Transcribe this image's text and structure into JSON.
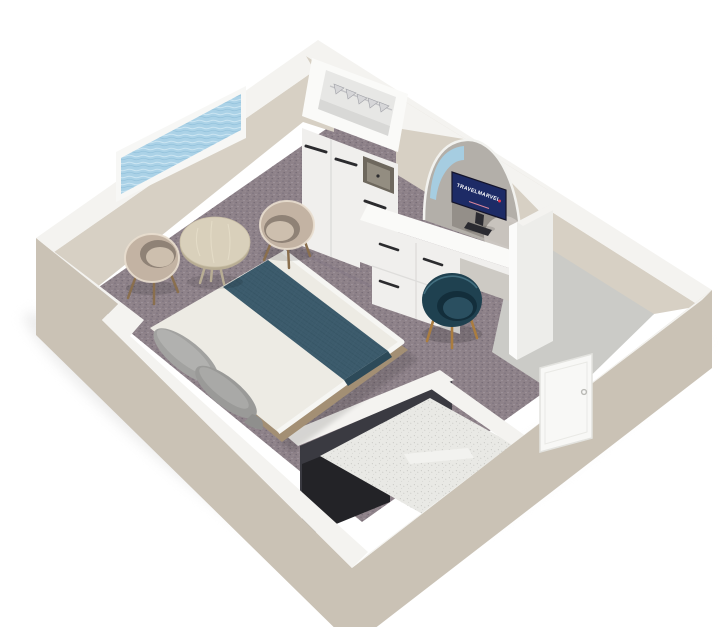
{
  "meta": {
    "scene": "cruise-cabin-3d-cutaway-floorplan",
    "view": "isometric-top-down"
  },
  "tv": {
    "brand": "TRAVELMARVEL",
    "screen": "#1d2b66",
    "frame": "#14142a",
    "stand": "#2a2a30",
    "dot": "#e0374e",
    "tagline_bar": "#ef8fa0"
  },
  "colors": {
    "background": "#ffffff",
    "wall_cut": "#f4f3f0",
    "wall_interior": "#d7d0c4",
    "wall_exterior": "#cac2b5",
    "window_frame": "#f7f7f5",
    "window_water": "#abd2e7",
    "carpet": "#8e8289",
    "entry_floor": "#cbcbc7",
    "cabinet_white": "#f0efed",
    "cabinet_top": "#fafaf8",
    "cabinet_interior": "#e7e7e5",
    "handle_dark": "#2b2b2e",
    "safe_recess": "#6e685e",
    "safe_front": "#938d81",
    "mirror": "#b3afa9",
    "mirror_dark": "#8e8a84",
    "mirror_light": "#cdc9c3",
    "mirror_water": "#a6cde1",
    "bed_duvet": "#edebe4",
    "bed_runner": "#3c5b6c",
    "bed_runner_dark": "#2d4a59",
    "bed_pillow": "#a2a2a0",
    "bed_wood": "#a38f74",
    "bed_rim": "#f6f6f3",
    "chair_shell": "#c3b3a3",
    "chair_inner": "#8f8276",
    "chair_seat": "#cdbfae",
    "chair_rim": "#e9decf",
    "chair_leg": "#8a6f4e",
    "armchair_shell": "#1f4150",
    "armchair_seat": "#2a4f60",
    "armchair_dark": "#132e3b",
    "armchair_leg": "#aa7d40",
    "table_top": "#d9d0bb",
    "table_edge": "#b8ad94",
    "bath_wall_dark": "#3a3a41",
    "bath_vanity": "#232327",
    "bath_floor": "#e9e9e5",
    "bath_speckle_gap": "#dcdcd8",
    "door_white": "#f8f8f6",
    "door_frame": "#e3e3df",
    "door_handle": "#b9b9b5",
    "hanger": "#d6d6d8",
    "hanger_hook": "#6a6b72"
  },
  "objects": [
    "sea-view-window",
    "wardrobe-with-hangers",
    "safe-niche",
    "dresser-desk-with-drawers",
    "arched-mirror",
    "tv",
    "double-bed-with-teal-runner",
    "tub-chair-left",
    "tub-chair-right",
    "round-table",
    "teal-armchair",
    "bathroom",
    "entry-vestibule",
    "entrance-door"
  ]
}
